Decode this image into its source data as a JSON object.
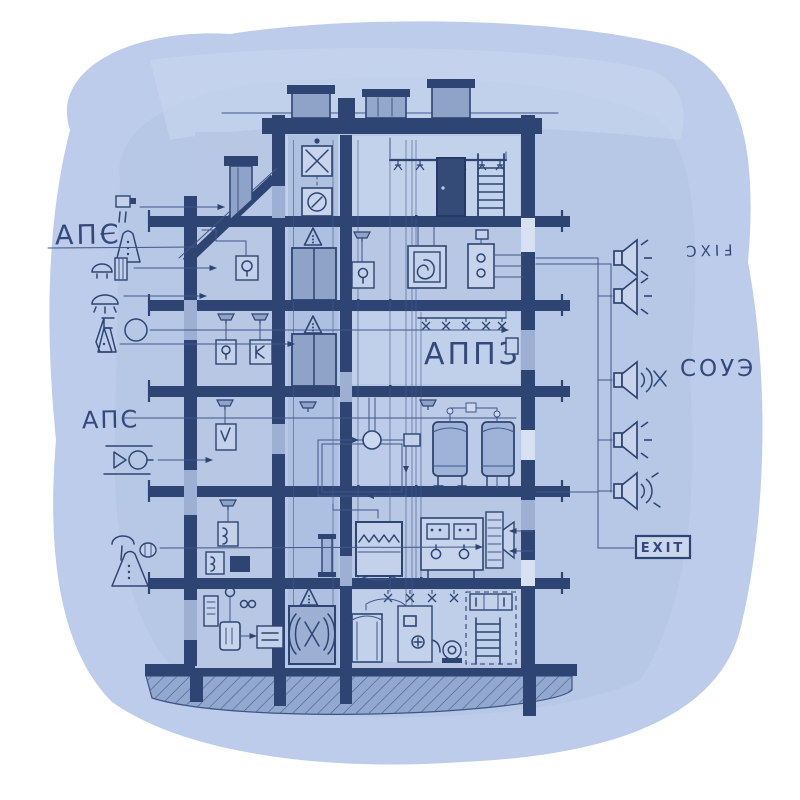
{
  "artwork": {
    "style": "hand-drawn blueprint on blue watercolor wash",
    "subject": "multi-storey building cross-section with fire alarm, suppression and evacuation systems"
  },
  "palette": {
    "paper": "#ffffff",
    "wash": "#bdccea",
    "wash_deep": "#afc1e4",
    "ink": "#2e4573",
    "ink_soft": "#41568a",
    "room": "#b7c7e4",
    "room_light": "#ccd8f0",
    "masonry_light": "#9db0d4",
    "metal": "#8fa3c8",
    "panel": "#c7d4ec",
    "earth": "#92a8ce"
  },
  "labels": {
    "aps_top": "АПС",
    "aps_mid": "АПС",
    "appz": "АППЗ",
    "soue": "СОУЭ",
    "exit_mirrored": "ƆXIℲ",
    "exit_sign": "EXIT"
  },
  "legend_left": {
    "items": [
      {
        "icon": "smoke-detector-icon"
      },
      {
        "icon": "manual-call-point-icon"
      },
      {
        "icon": "heat-detector-icon"
      },
      {
        "icon": "dome-lamp-icon"
      },
      {
        "icon": "flask-and-circle-icon"
      },
      {
        "icon": "fan-valve-icon"
      },
      {
        "icon": "smoke-vent-icon"
      },
      {
        "icon": "warning-triangle-icon"
      }
    ]
  },
  "right_column": {
    "speakers": [
      {
        "icon": "loudspeaker-rays-icon"
      },
      {
        "icon": "loudspeaker-rays-icon"
      },
      {
        "icon": "loudspeaker-waves-icon"
      },
      {
        "icon": "loudspeaker-rays-icon"
      },
      {
        "icon": "loudspeaker-waves-icon"
      }
    ]
  }
}
